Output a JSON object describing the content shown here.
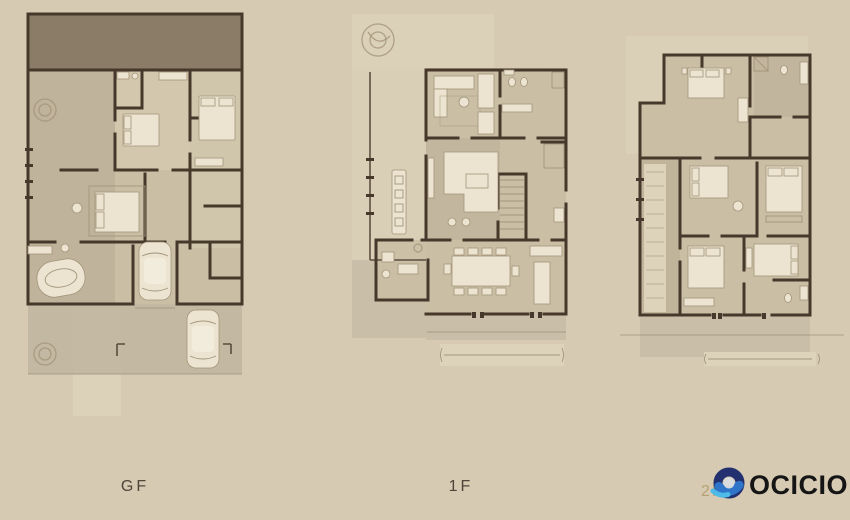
{
  "palette": {
    "background": "#d6cab2",
    "floor": "#cabfa5",
    "floor_dark": "#b4a991",
    "floor_light": "#ddd3bb",
    "deck": "#bcb29b",
    "wall": "#46392b",
    "furniture": "#ece4d0",
    "furniture_edge": "#a3947a",
    "roof": "#8b7c67",
    "tree": "#a2947b",
    "ground_line": "#948a73",
    "label": "#4f4539",
    "label_2f": "#b5a173",
    "brand_text": "#151515",
    "brand_navy": "#22306f",
    "brand_blue": "#2e74c9",
    "brand_cyan": "#4dbae8",
    "logo_hole": "#d9dde0"
  },
  "plans": [
    {
      "id": "gf",
      "label": "GF"
    },
    {
      "id": "1f",
      "label": "1F"
    },
    {
      "id": "2f",
      "label": "2F"
    }
  ],
  "brand": {
    "name": "OCICIO",
    "icon": "swirl-donut-icon"
  }
}
